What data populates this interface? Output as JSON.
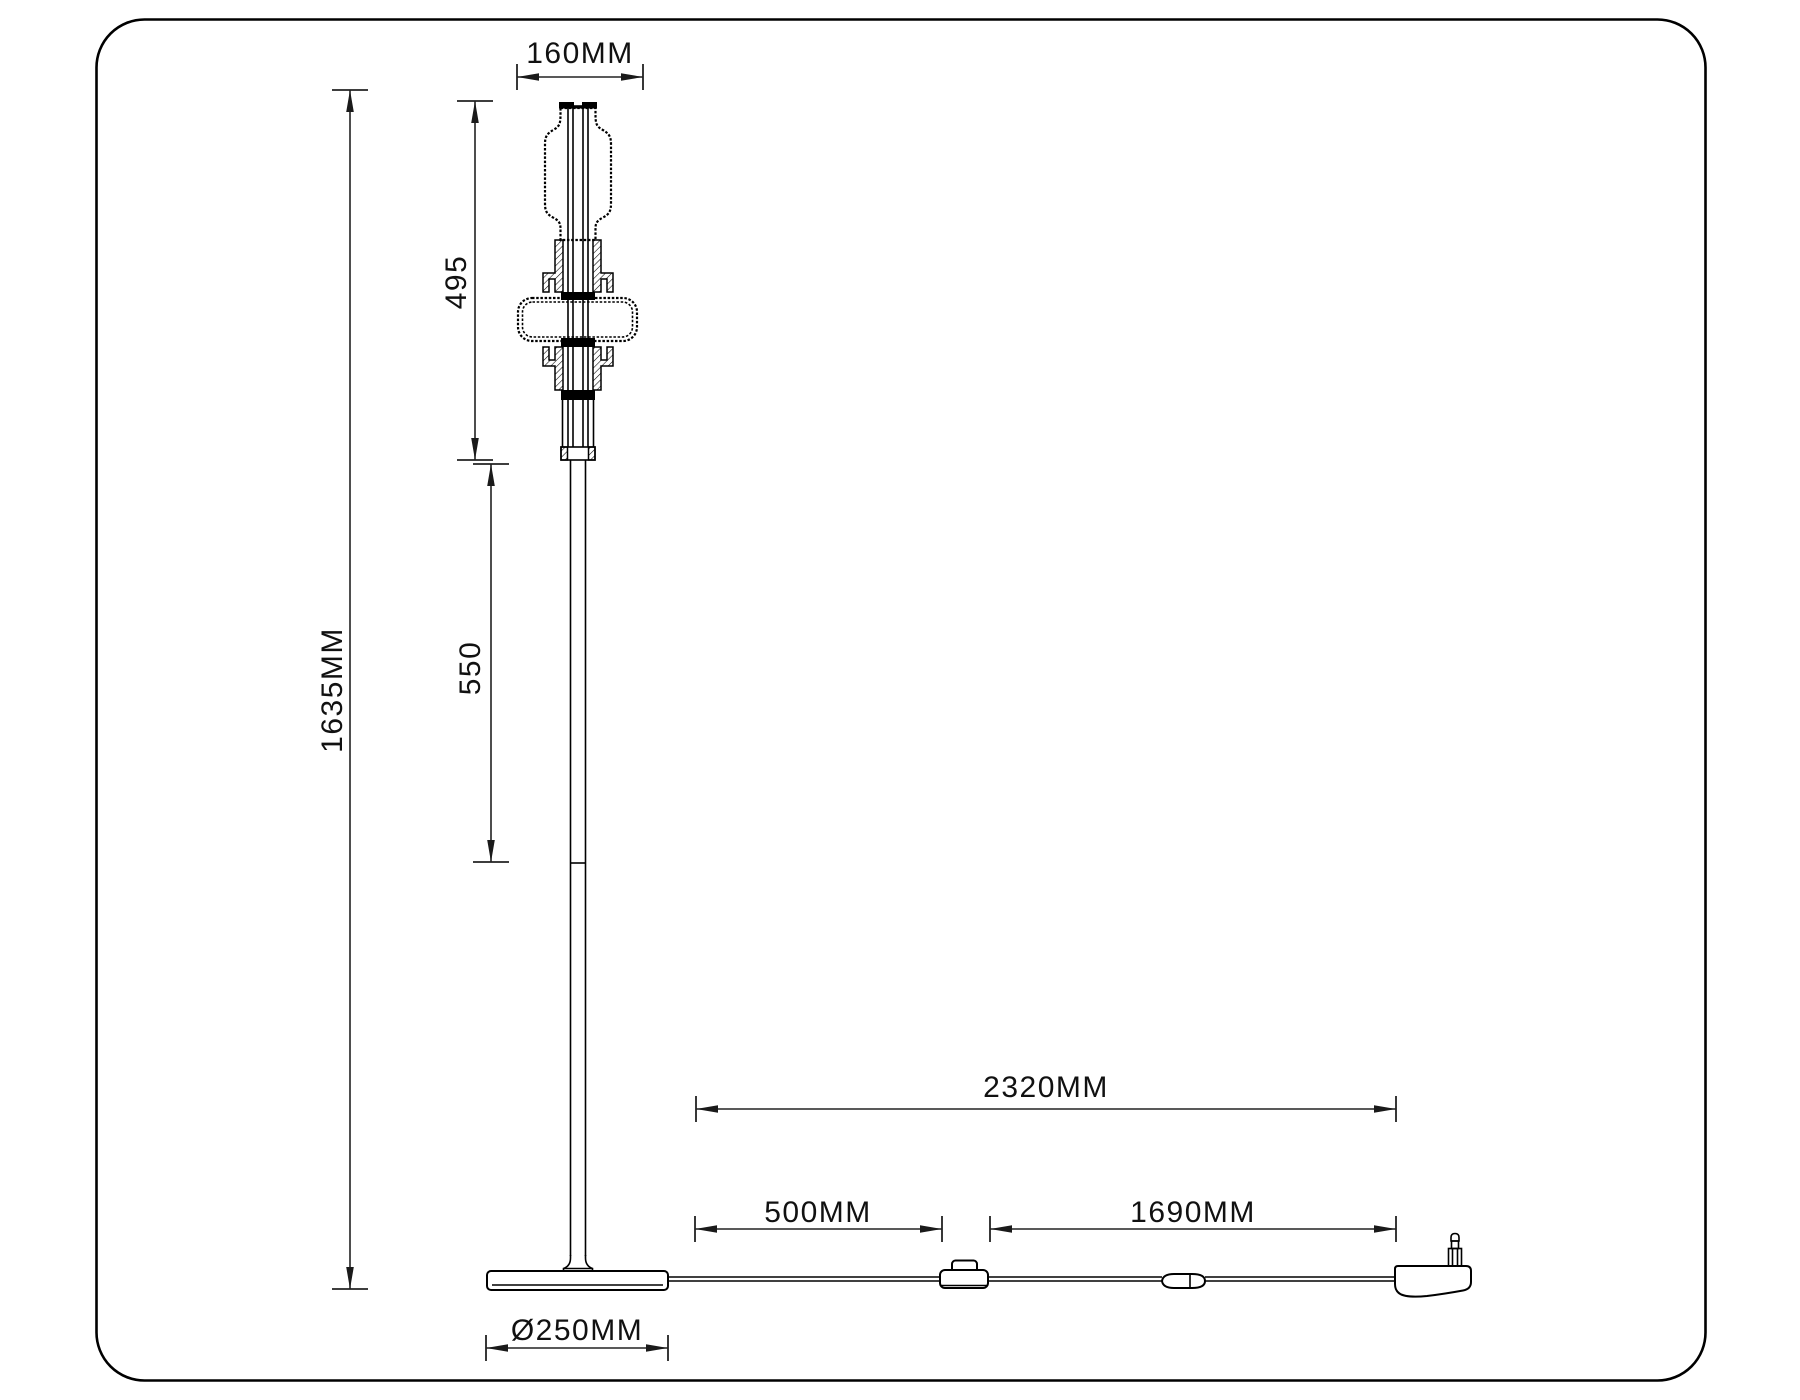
{
  "drawing": {
    "title": "floor-lamp-dimension-drawing",
    "dimensions": {
      "head_width": "160MM",
      "head_section_height": "495",
      "upper_pole_length": "550",
      "total_height": "1635MM",
      "cord_total_length": "2320MM",
      "base_to_switch": "500MM",
      "switch_to_plug": "1690MM",
      "base_diameter": "Ø250MM"
    },
    "colors": {
      "ink": "#000000",
      "dimension_ink": "#222222",
      "background": "#ffffff"
    }
  }
}
